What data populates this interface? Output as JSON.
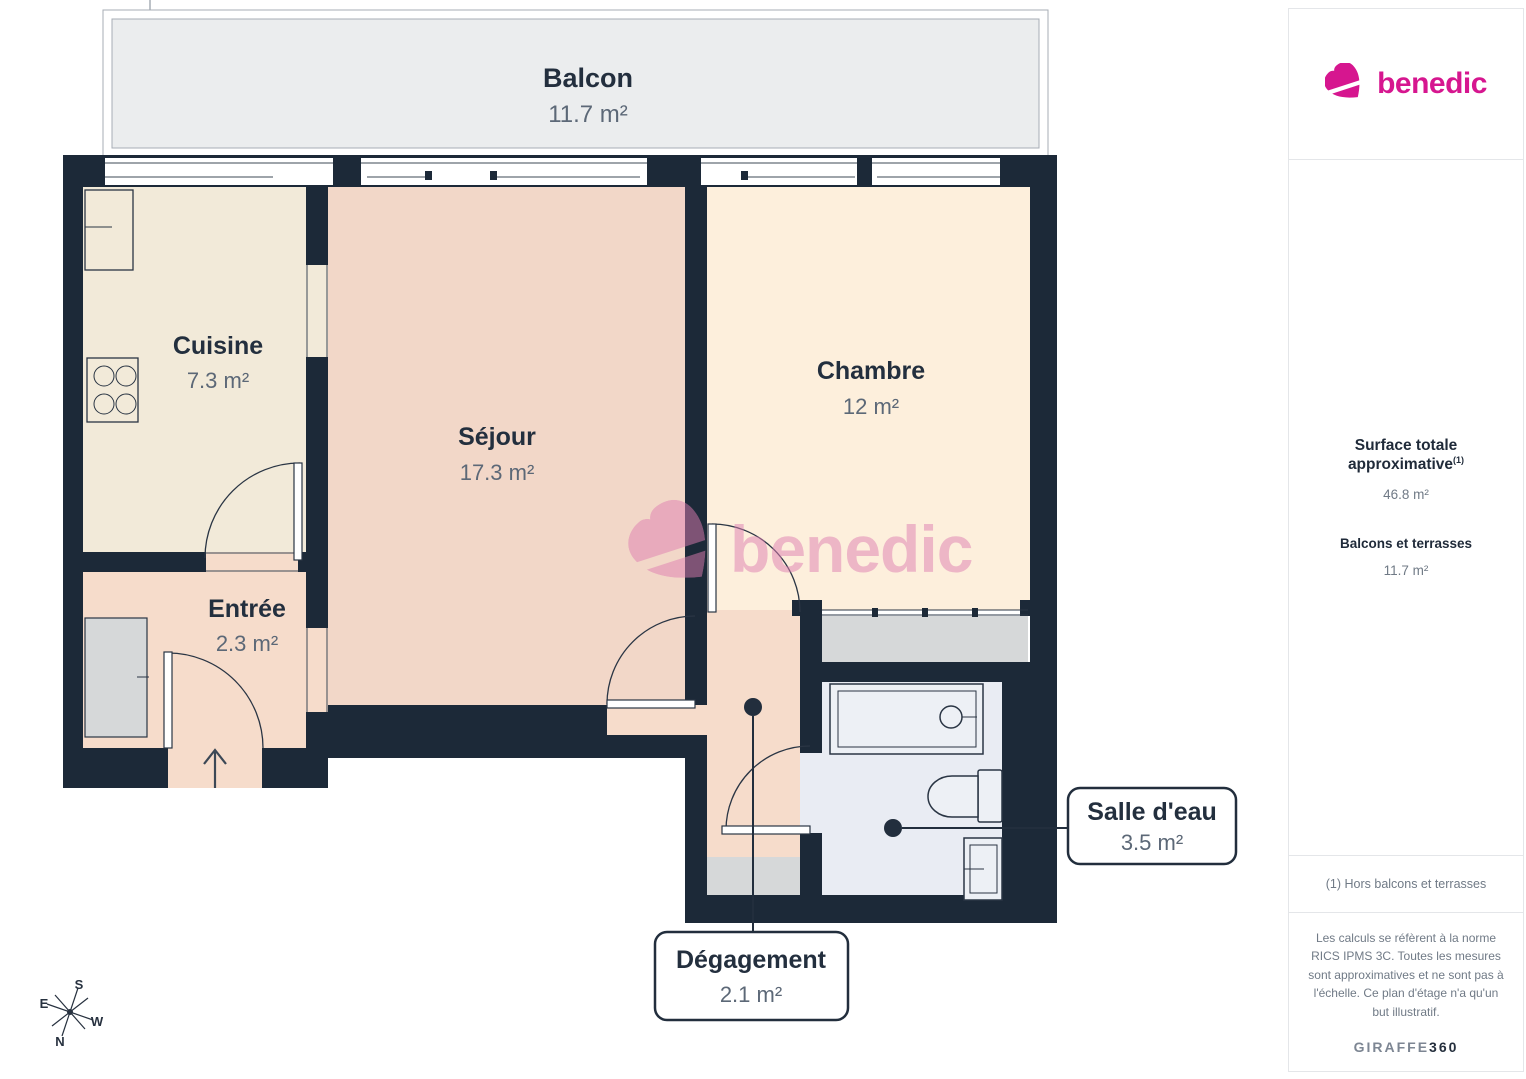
{
  "plan": {
    "rooms": {
      "balcon": {
        "name": "Balcon",
        "area": "11.7 m²"
      },
      "cuisine": {
        "name": "Cuisine",
        "area": "7.3 m²"
      },
      "sejour": {
        "name": "Séjour",
        "area": "17.3 m²"
      },
      "chambre": {
        "name": "Chambre",
        "area": "12 m²"
      },
      "entree": {
        "name": "Entrée",
        "area": "2.3 m²"
      },
      "salle_deau": {
        "name": "Salle d'eau",
        "area": "3.5 m²"
      },
      "degagement": {
        "name": "Dégagement",
        "area": "2.1 m²"
      }
    },
    "compass": {
      "n": "N",
      "s": "S",
      "e": "E",
      "w": "W"
    },
    "watermark": "benedic"
  },
  "sidebar": {
    "brand": "benedic",
    "surface_title": "Surface totale approximative",
    "surface_sup": "(1)",
    "surface_value": "46.8 m²",
    "balcony_title": "Balcons et terrasses",
    "balcony_value": "11.7 m²",
    "footnote": "(1) Hors balcons et terrasses",
    "legal": "Les calculs se réfèrent à la norme RICS IPMS 3C. Toutes les mesures sont approximatives et ne sont pas à l'échelle. Ce plan d'étage n'a qu'un but illustratif.",
    "brand_footer_1": "GIRAFFE",
    "brand_footer_2": "360"
  },
  "colors": {
    "wall": "#1c2938",
    "brand_magenta": "#d6168f",
    "watermark_pink": "#df7eb2",
    "cuisine_fill": "#f2ead9",
    "sejour_fill": "#f2d7c8",
    "chambre_fill": "#fdefdc",
    "entree_fill": "#f6dccb",
    "bath_fill": "#e9ecf3",
    "balcony_fill": "#ebedee",
    "closet_gray": "#d6d8d9"
  }
}
